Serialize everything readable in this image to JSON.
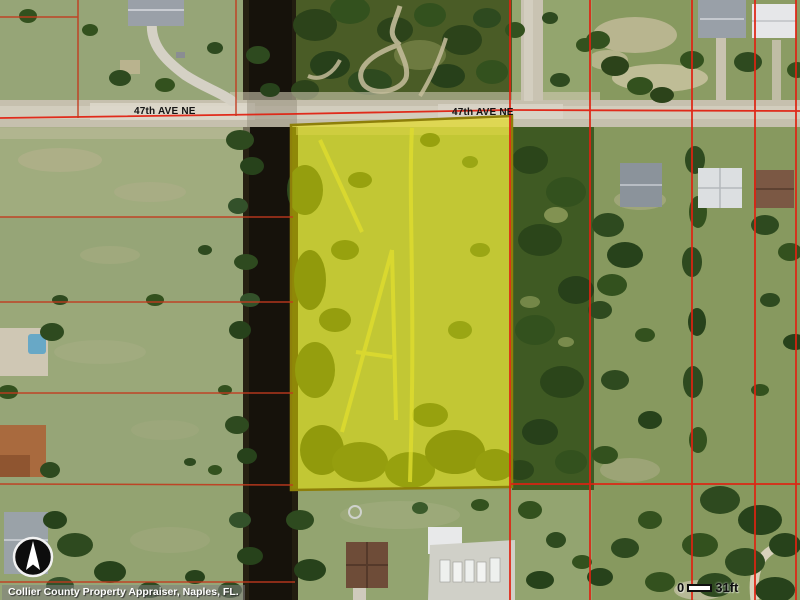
{
  "map": {
    "street_labels": [
      "47th AVE NE",
      "47th AVE NE"
    ],
    "attribution_text": "Collier County Property Appraiser, Naples, FL.",
    "scale_bar": {
      "start": "0",
      "end": "31ft"
    },
    "icons": {
      "north_arrow": "north-arrow"
    }
  },
  "colors": {
    "parcel_line": "#e02212",
    "parcel_line_dim": "#c23a1e",
    "highlight_fill": "rgba(243,236,0,0.52)",
    "highlight_border": "#8d7f0a",
    "canal_water": "#16120b",
    "road_surface": "#c6c0ae",
    "attribution_bg": "rgba(125,125,125,0.55)"
  }
}
